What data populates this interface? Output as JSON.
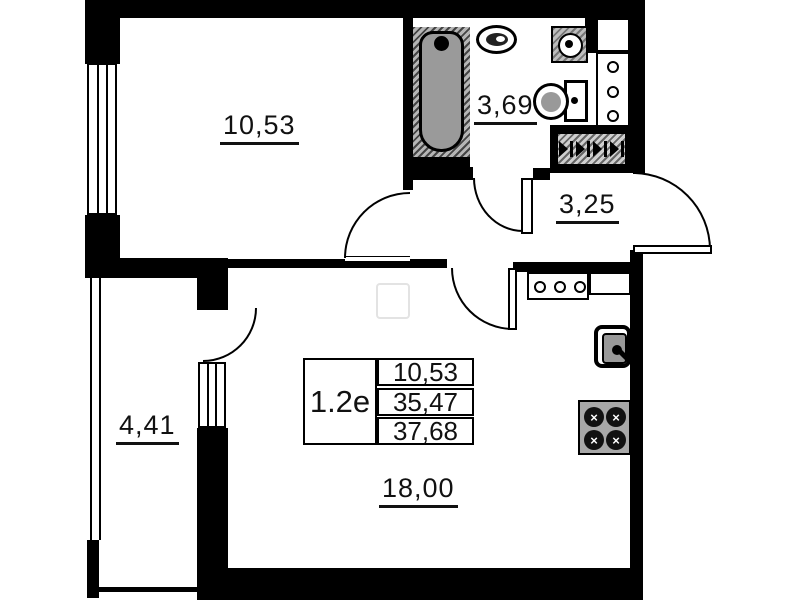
{
  "title": "apartment floor plan 1.2e",
  "rooms": {
    "bedroom": {
      "area": "10,53"
    },
    "bathroom": {
      "area": "3,69"
    },
    "hallway": {
      "area": "3,25"
    },
    "balcony": {
      "area": "4,41"
    },
    "living": {
      "area": "18,00"
    }
  },
  "unit_card": {
    "unit": "1.2e",
    "values": [
      "10,53",
      "35,47",
      "37,68"
    ]
  },
  "glyphs": {
    "burner": "×"
  },
  "colors": {
    "wall": "#000000",
    "fixture_gray": "#9a9a9a",
    "background": "#ffffff"
  }
}
